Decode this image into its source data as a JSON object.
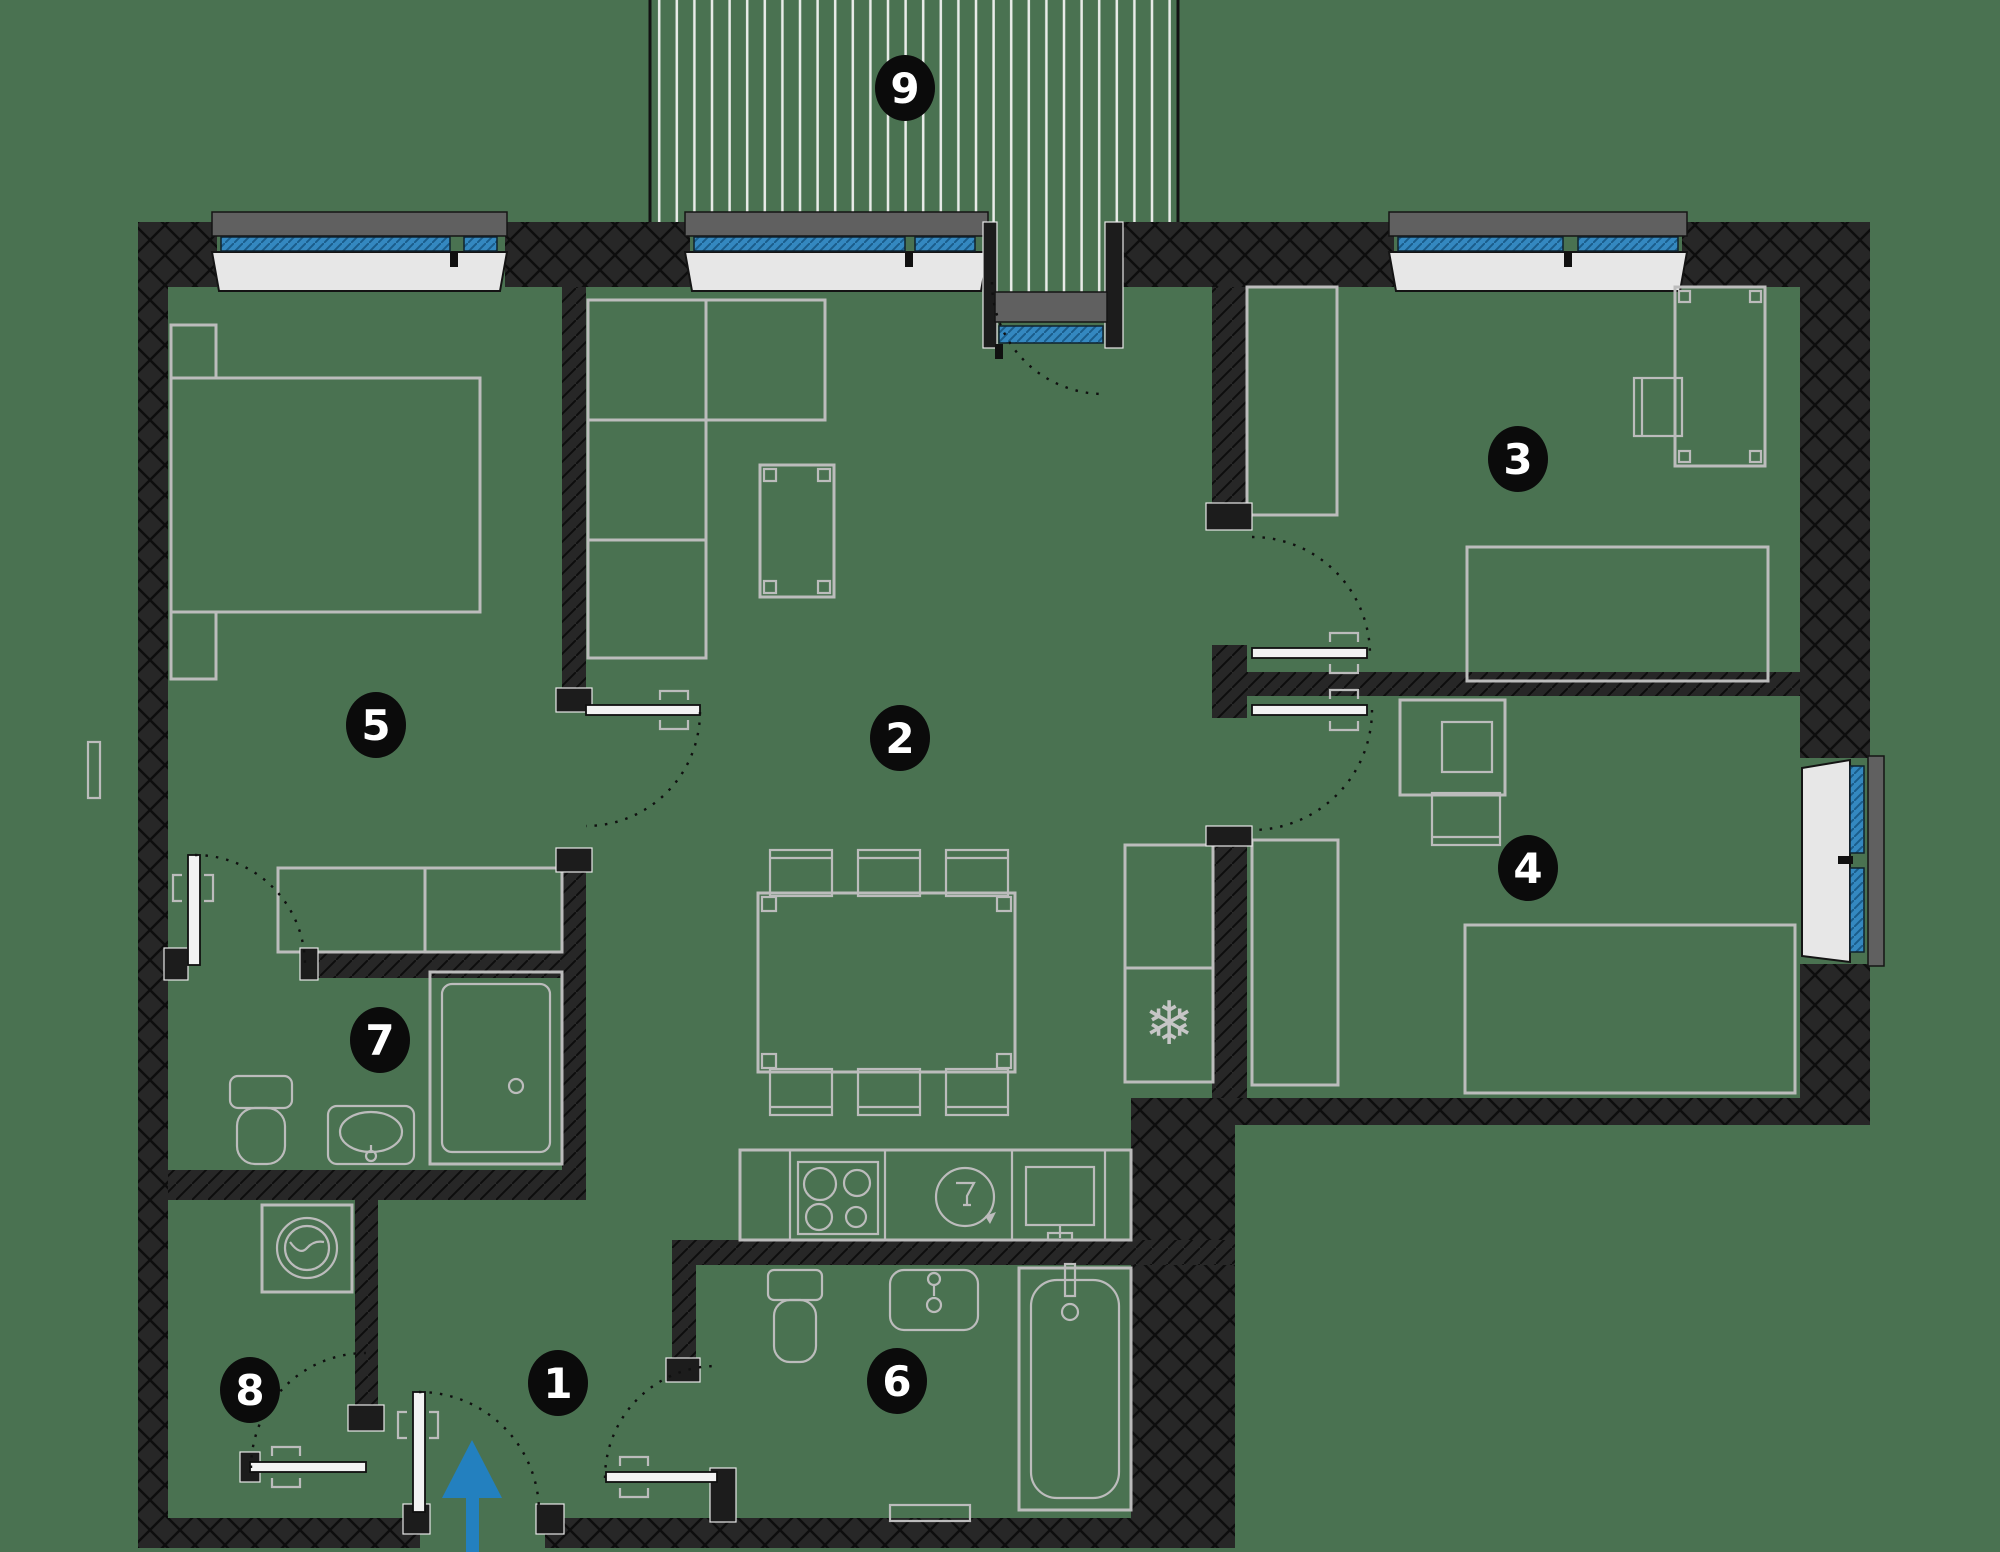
{
  "plan": {
    "type": "apartment-floor-plan",
    "colors": {
      "background_color": "#4a7251",
      "wall_color": "#272727",
      "furniture_stroke": "#bcbcbc",
      "window_sill_color": "#e7e7e7",
      "window_frame_color": "#606060",
      "glazing_color": "#3488c0",
      "terrace_stripe_color": "#e9ece9",
      "badge_color": "#0b0b0b",
      "badge_text_color": "#ffffff",
      "entrance_arrow_color": "#2380bf"
    }
  },
  "rooms": [
    {
      "number": "1",
      "name": "hall"
    },
    {
      "number": "2",
      "name": "living-kitchen"
    },
    {
      "number": "3",
      "name": "bedroom"
    },
    {
      "number": "4",
      "name": "bedroom"
    },
    {
      "number": "5",
      "name": "bedroom"
    },
    {
      "number": "6",
      "name": "bathroom"
    },
    {
      "number": "7",
      "name": "shower-room"
    },
    {
      "number": "8",
      "name": "storage"
    },
    {
      "number": "9",
      "name": "terrace"
    }
  ],
  "icons": {
    "fridge_glyph": "❄"
  }
}
